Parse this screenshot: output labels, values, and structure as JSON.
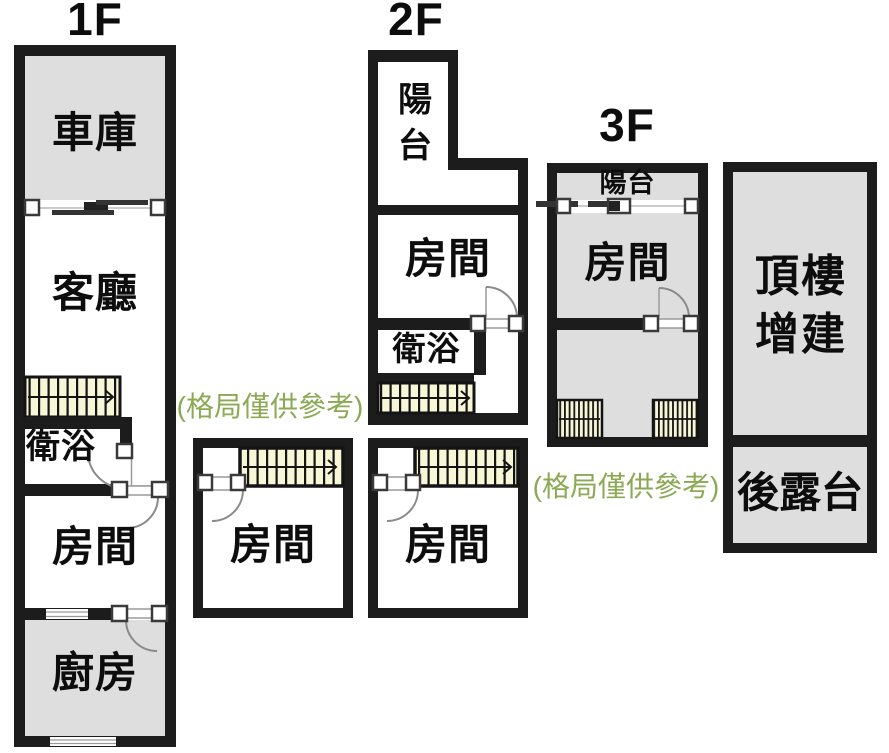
{
  "floors": {
    "f1": {
      "label": "1F",
      "garage": "車庫",
      "living_room": "客廳",
      "bathroom": "衛浴",
      "bedroom": "房間",
      "kitchen": "廚房",
      "rear_bedroom": "房間"
    },
    "f2": {
      "label": "2F",
      "balcony": "陽台",
      "bedroom": "房間",
      "bathroom": "衛浴",
      "rear_bedroom": "房間"
    },
    "f3": {
      "label": "3F",
      "balcony": "陽台",
      "bedroom": "房間",
      "rooftop_addition": "頂樓增建",
      "rear_terrace": "後露台"
    }
  },
  "notes": {
    "disclaimer_left": "(格局僅供參考)",
    "disclaimer_right": "(格局僅供參考)"
  },
  "colors": {
    "wall": "#1c1c1c",
    "room_fill_gray": "#dedede",
    "stair_fill": "#f7f7d8",
    "note_green": "#8ca953",
    "door_line": "#8a8a8a"
  }
}
